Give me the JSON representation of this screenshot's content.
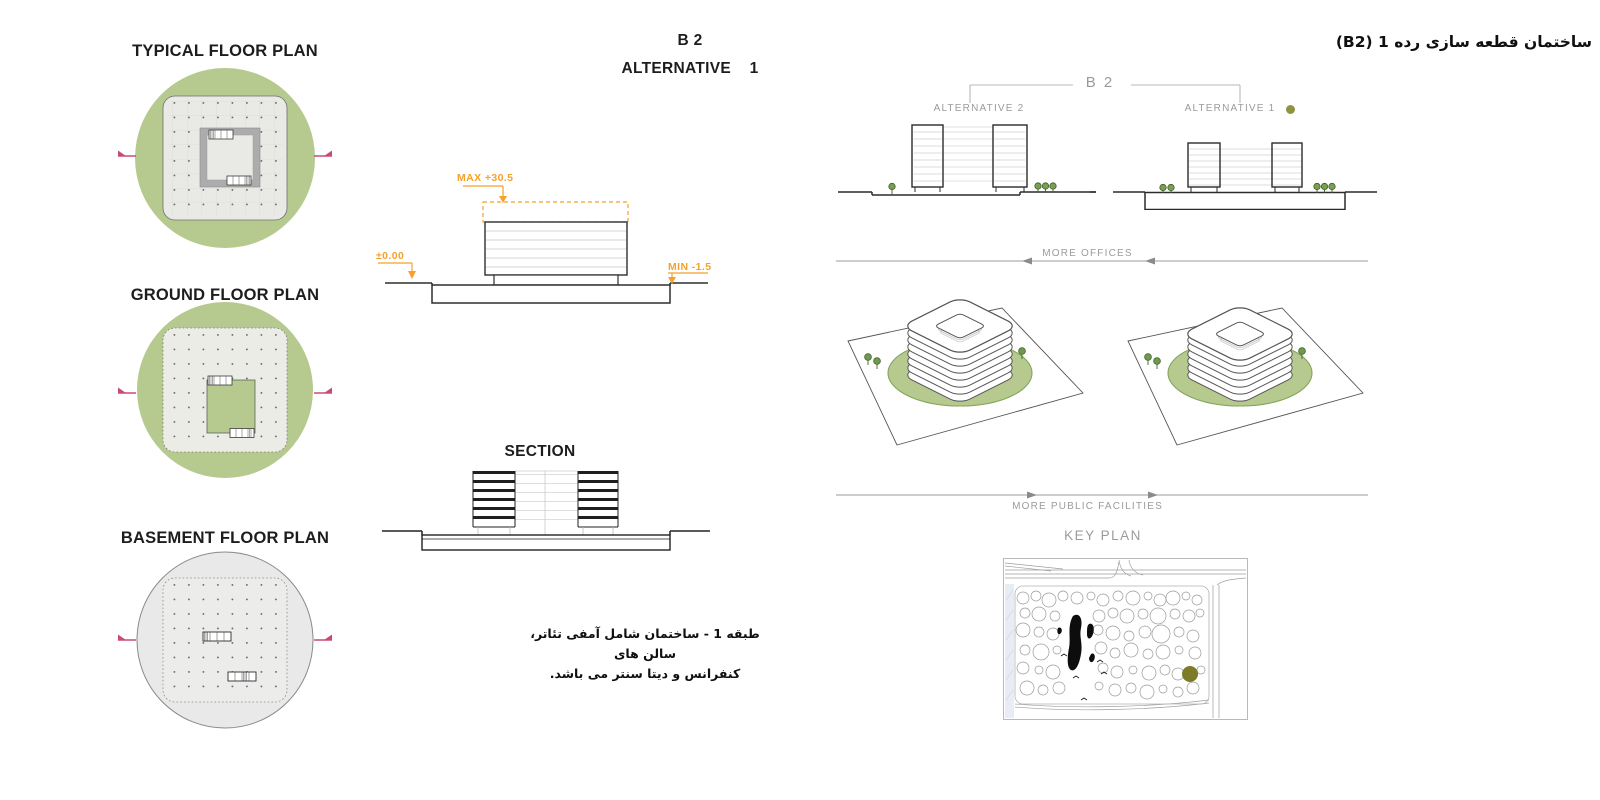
{
  "sheet": {
    "farsi_header": "ساختمان قطعه سازی رده 1 (B2)",
    "farsi_caption_line1": "طبقه 1 - ساختمان شامل آمفی تئاتر، سالن های",
    "farsi_caption_line2": "کنفرانس و دیتا سنتر می باشد."
  },
  "plans": {
    "typical_title": "TYPICAL FLOOR PLAN",
    "ground_title": "GROUND FLOOR PLAN",
    "basement_title": "BASEMENT FLOOR PLAN"
  },
  "center": {
    "b2_line1": "B 2",
    "b2_line2": "ALTERNATIVE 1",
    "section_title": "SECTION",
    "annotation_max": "MAX +30.5",
    "annotation_zero": "±0.00",
    "annotation_min": "MIN -1.5"
  },
  "right": {
    "b2_title": "B 2",
    "alternative_2": "ALTERNATIVE 2",
    "alternative_1": "ALTERNATIVE 1",
    "more_offices": "MORE OFFICES",
    "more_public_facilities": "MORE PUBLIC FACILITIES",
    "key_plan": "KEY PLAN"
  },
  "colors": {
    "plan_green": "#B6CA8F",
    "accent_orange": "#F5A12B",
    "section_marker_pink": "#C84A7B",
    "alt1_dot_olive": "#8E9340",
    "keyplan_parcel_olive": "#7C7C28",
    "label_gray": "#9B9B9B"
  }
}
